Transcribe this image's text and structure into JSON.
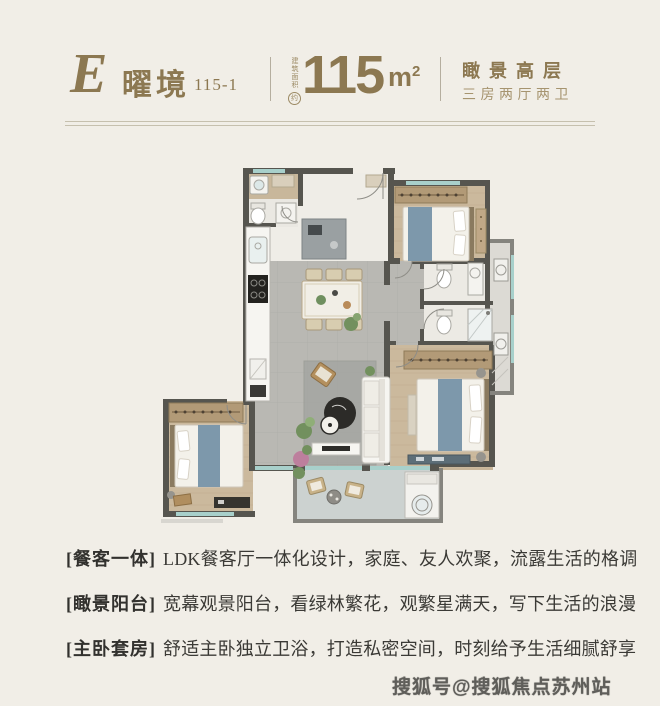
{
  "header": {
    "unit_letter": "E",
    "unit_name": "曜境",
    "unit_code": "115-1",
    "area_prefix": "建筑面积",
    "area_approx": "约",
    "area_value": "115",
    "area_unit_base": "m",
    "area_unit_exp": "2",
    "feature_title": "瞰景高层",
    "feature_sub": "三房两厅两卫"
  },
  "features": [
    {
      "tag": "[餐客一体]",
      "desc": "LDK餐客厅一体化设计，家庭、友人欢聚，流露生活的格调"
    },
    {
      "tag": "[瞰景阳台]",
      "desc": "宽幕观景阳台，看绿林繁花，观繁星满天，写下生活的浪漫"
    },
    {
      "tag": "[主卧套房]",
      "desc": "舒适主卧独立卫浴，打造私密空间，时刻给予生活细腻舒享"
    }
  ],
  "watermark": "搜狐号@搜狐焦点苏州站",
  "colors": {
    "accent_gold": "#8c7851",
    "accent_gold_light": "#a6946f",
    "background": "#f1eee7",
    "wall": "#56554f",
    "tile_floor": "#b9b8b3",
    "wood_floor": "#cbb99d",
    "window_teal": "#a8d0cb",
    "bed_blue": "#7d98ab",
    "text_dark": "#3b3a36"
  }
}
